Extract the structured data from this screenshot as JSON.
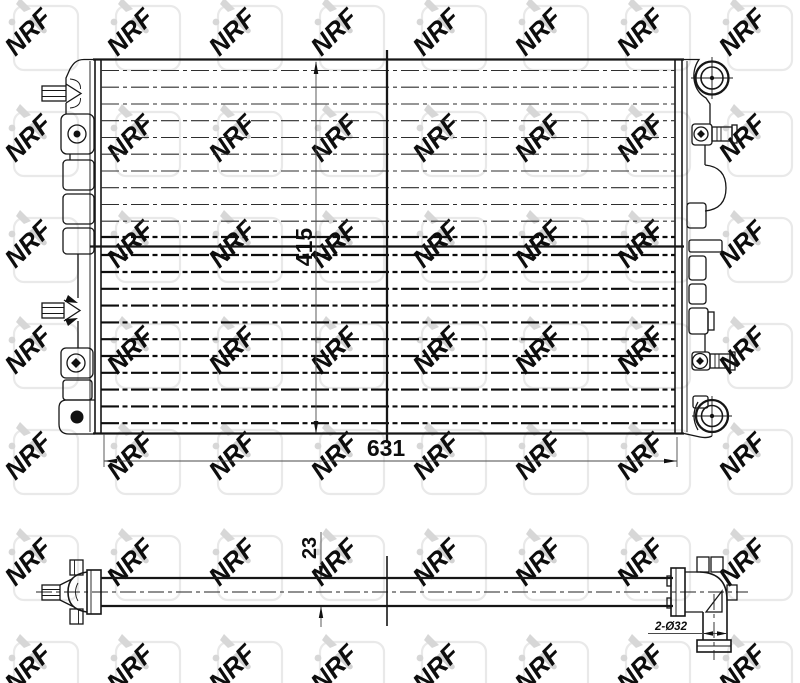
{
  "watermark": {
    "text": "NRF",
    "color": "#d4d4d4"
  },
  "dimensions": {
    "height_label": "415",
    "width_label": "631",
    "depth_label": "23",
    "ports_label": "2-Ø32"
  },
  "colors": {
    "line": "#161616",
    "background": "#ffffff",
    "watermark_square": "#e8e8e8"
  }
}
